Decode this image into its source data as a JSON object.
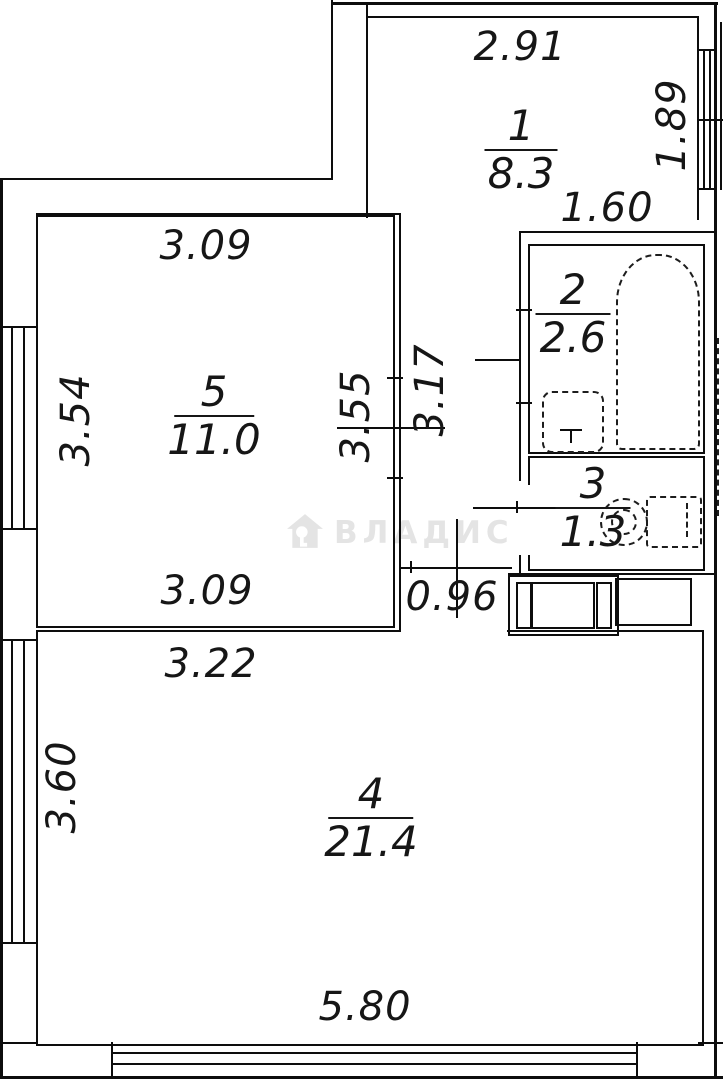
{
  "plan": {
    "watermark": {
      "text": "ВЛАДИС",
      "icon": "house-key-icon",
      "color": "#e4e4e4"
    },
    "rooms": {
      "r1": {
        "number": "1",
        "area": "8.3"
      },
      "r2": {
        "number": "2",
        "area": "2.6"
      },
      "r3": {
        "number": "3",
        "area": "1.3"
      },
      "r4": {
        "number": "4",
        "area": "21.4"
      },
      "r5": {
        "number": "5",
        "area": "11.0"
      }
    },
    "dims": {
      "room1_width": "2.91",
      "room1_window": "1.89",
      "bath_width": "1.60",
      "room5_width_top": "3.09",
      "room5_depth_left": "3.54",
      "room5_depth_right": "3.55",
      "hall_depth": "3.17",
      "room5_width_bottom": "3.09",
      "room4_width_top": "3.22",
      "hall_passage_width": "0.96",
      "room4_depth_left": "3.60",
      "room4_width_bottom": "5.80"
    },
    "colors": {
      "line": "#0d0d0d",
      "watermark": "#e4e4e4"
    }
  }
}
